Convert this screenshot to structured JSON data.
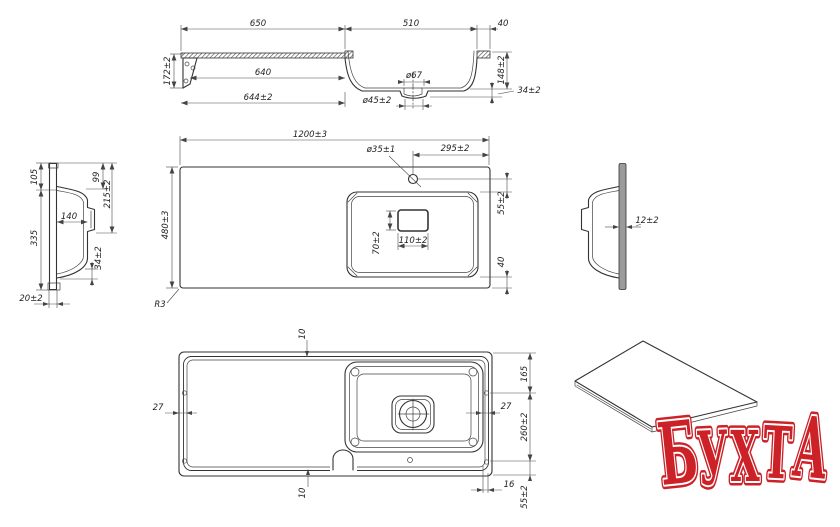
{
  "colors": {
    "line": "#333333",
    "dim": "#4a4a4a",
    "hatch_fill": "#999999",
    "logo_red": "#cc2127"
  },
  "logo": {
    "word": "БУХТА",
    "letters": [
      "Б",
      "У",
      "Х",
      "Т",
      "А"
    ],
    "color": "#cc2127"
  },
  "dims": {
    "elevation": {
      "len_left": "650",
      "len_bowl": "510",
      "len_right": "40",
      "height_left": "172±2",
      "len_inner": "640",
      "len_outer": "644±2",
      "drain_top_dia": "ø67",
      "drain_bottom_dia": "ø45±2",
      "bowl_depth": "148±2",
      "bottom_gap": "34±2"
    },
    "plan": {
      "total_width": "1200±3",
      "total_depth": "480±3",
      "faucet_dia": "ø35±1",
      "faucet_offset": "295±2",
      "faucet_to_bowl": "55±2",
      "overflow_width": "110±2",
      "overflow_height": "70±2",
      "bowl_to_edge": "40",
      "corner_radius": "R3"
    },
    "section_left": {
      "rim_to_top": "105",
      "rim_to_bottom": "335",
      "inner_depth": "99",
      "overall_depth": "215±2",
      "bowl_width": "140",
      "base_gap": "34±2",
      "panel_thickness": "20±2"
    },
    "section_right": {
      "panel_thickness": "12±2"
    },
    "bottom": {
      "edge_top": "10",
      "edge_bottom": "10",
      "edge_left": "27",
      "edge_right": "27",
      "top_offset": "165",
      "bowl_length": "260±2",
      "side_gap": "16",
      "bottom_offset": "55±2"
    }
  }
}
